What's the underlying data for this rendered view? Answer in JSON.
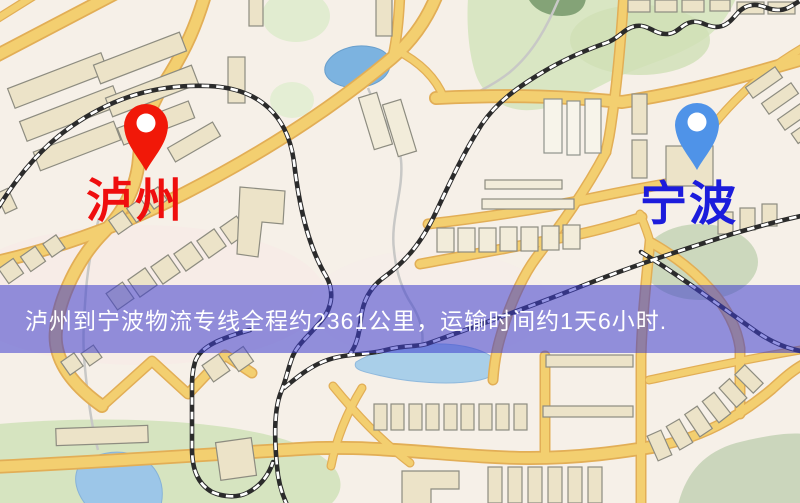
{
  "banner": {
    "text": "泸州到宁波物流专线全程约2361公里，运输时间约1天6小时.",
    "bg_color": "rgba(62,62,205,0.55)",
    "text_color": "#ffffff"
  },
  "origin": {
    "name": "泸州",
    "label_color": "#ef0e0e",
    "pin_color": "#f11808"
  },
  "destination": {
    "name": "宁波",
    "label_color": "#1c1cdc",
    "pin_color": "#4f93e8"
  },
  "map_palette": {
    "background": "#f6f0e8",
    "road": "#f3cf70",
    "road_casing": "#e2ae56",
    "building": "#ece3c8",
    "park_green": "#d9e6c3",
    "water_blue": "#7cb3e0",
    "railway": "#2b2b2b",
    "pin_hole": "#ffffff"
  }
}
